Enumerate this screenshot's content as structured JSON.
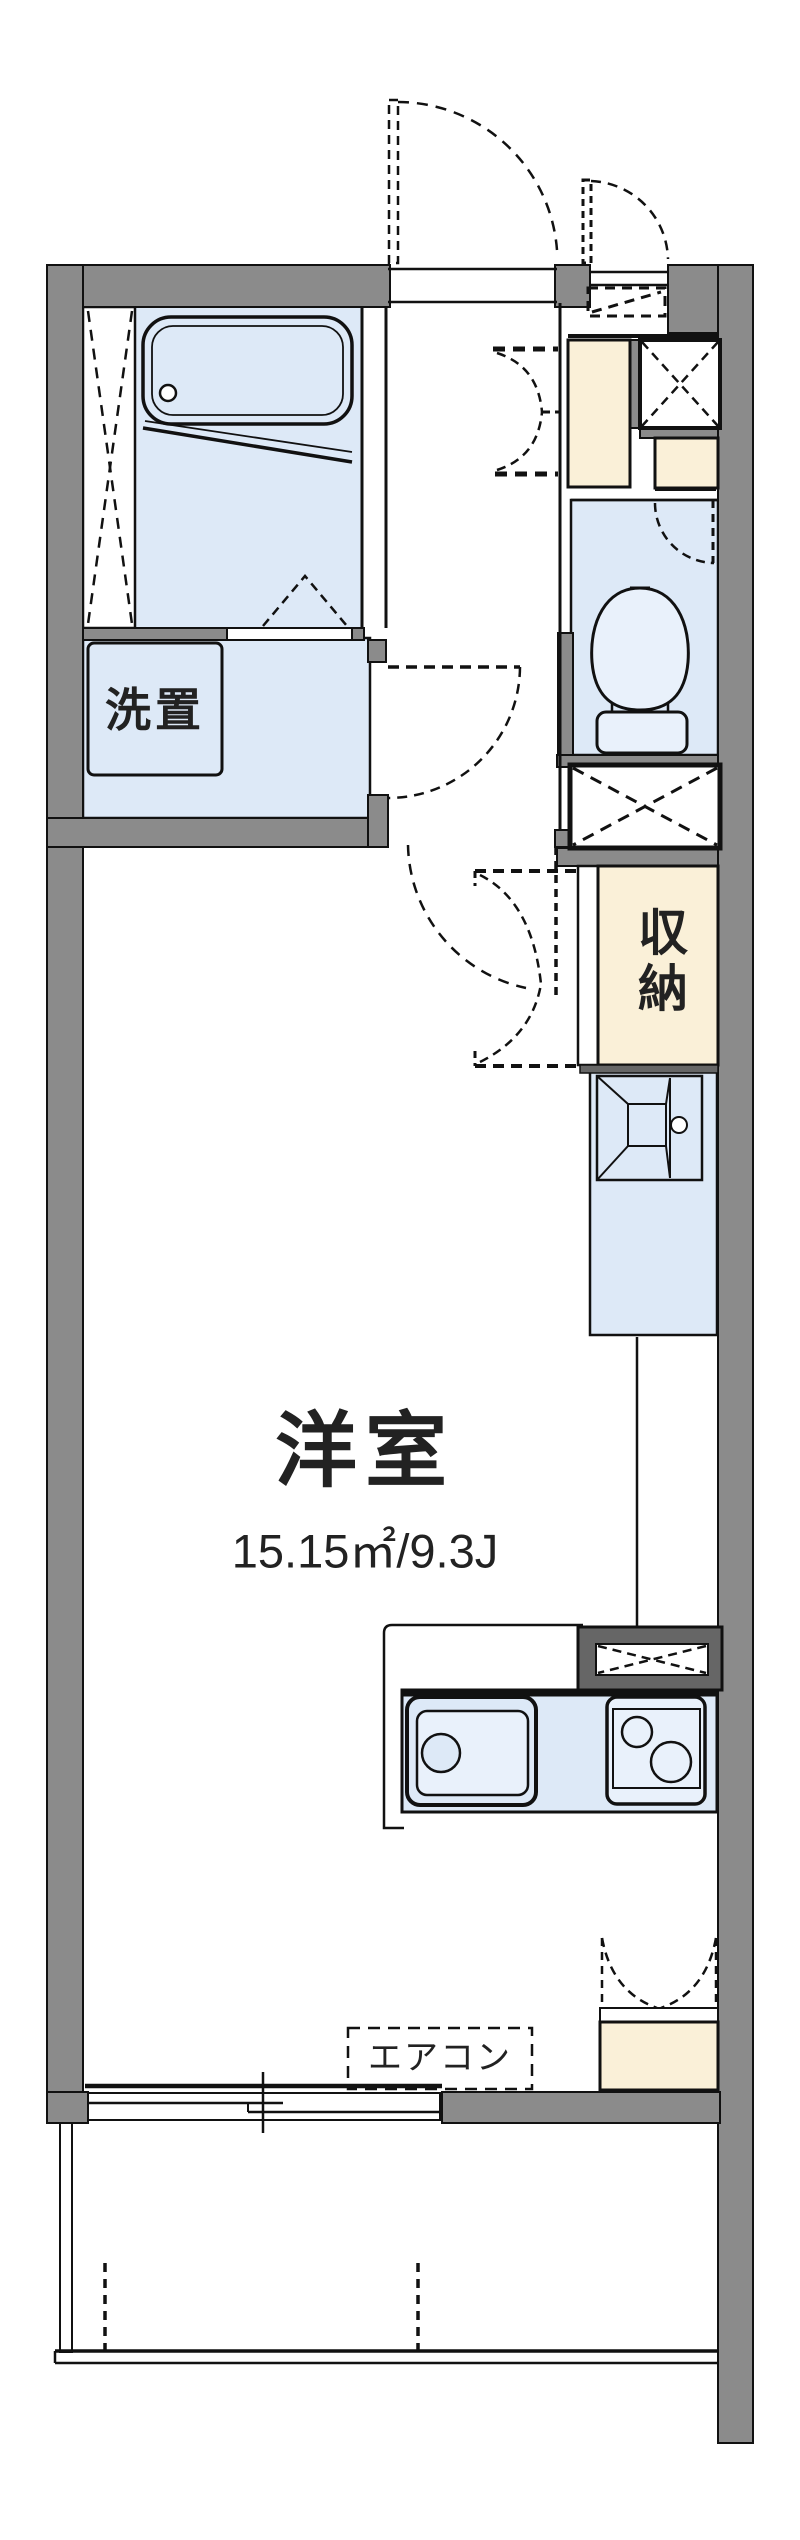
{
  "colors": {
    "wall_gray": "#8b8b8b",
    "frame_dark_gray": "#666666",
    "room_blue": "#dde9f7",
    "fixture_blue": "#e9f1fb",
    "closet_cream": "#faf0d8",
    "line_black": "#111111",
    "text": "#222222"
  },
  "plan": {
    "labels": {
      "laundry": "洗置",
      "storage": "収納",
      "living_room": "洋室",
      "living_room_area": "15.15㎡/9.3J",
      "aircon": "エアコン"
    }
  }
}
